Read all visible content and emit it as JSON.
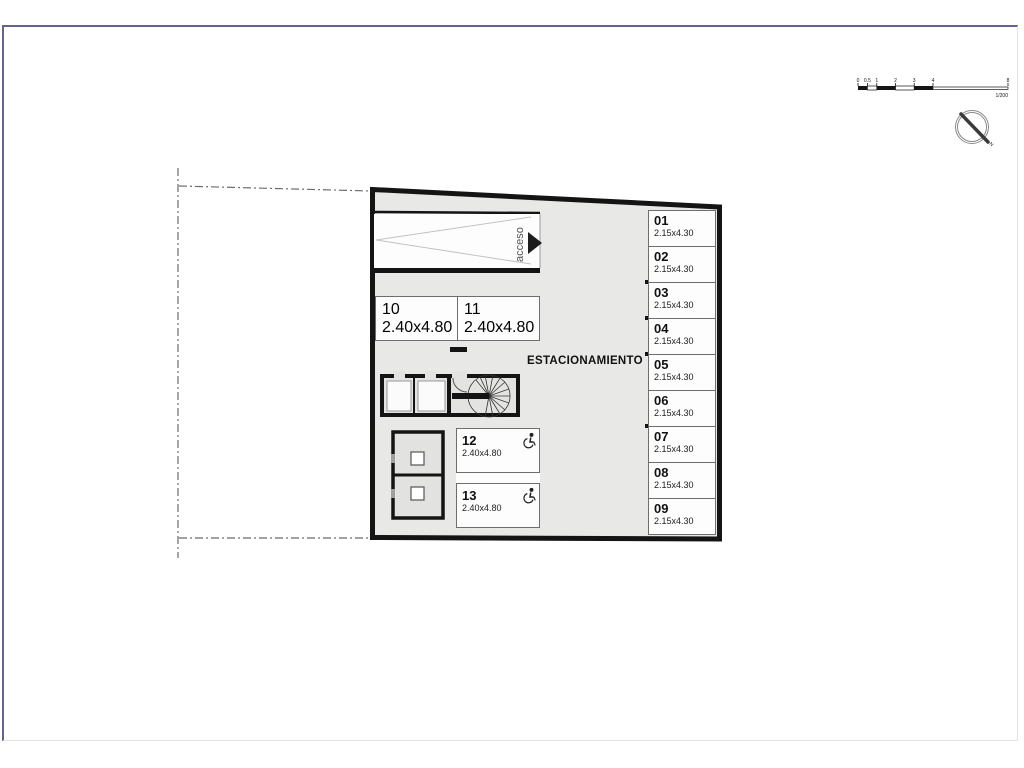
{
  "scale_bar": {
    "labels": [
      "0",
      "0.5",
      "1",
      "2",
      "3",
      "4",
      "8"
    ],
    "ratio_label": "1/200"
  },
  "compass": {
    "north_label": "N"
  },
  "plan": {
    "area_label": "ESTACIONAMIENTO",
    "ramp": {
      "label": "acceso"
    },
    "stalls_right": [
      {
        "number": "01",
        "dim": "2.15x4.30"
      },
      {
        "number": "02",
        "dim": "2.15x4.30"
      },
      {
        "number": "03",
        "dim": "2.15x4.30"
      },
      {
        "number": "04",
        "dim": "2.15x4.30"
      },
      {
        "number": "05",
        "dim": "2.15x4.30"
      },
      {
        "number": "06",
        "dim": "2.15x4.30"
      },
      {
        "number": "07",
        "dim": "2.15x4.30"
      },
      {
        "number": "08",
        "dim": "2.15x4.30"
      },
      {
        "number": "09",
        "dim": "2.15x4.30"
      }
    ],
    "stalls_top": [
      {
        "number": "10",
        "dim": "2.40x4.80"
      },
      {
        "number": "11",
        "dim": "2.40x4.80"
      }
    ],
    "stalls_accessible": [
      {
        "number": "12",
        "dim": "2.40x4.80"
      },
      {
        "number": "13",
        "dim": "2.40x4.80"
      }
    ],
    "icons": {
      "accessible": "wheelchair-icon",
      "ramp_direction": "access-arrow-icon",
      "north": "north-compass-icon"
    },
    "colors": {
      "wall": "#141414",
      "floor": "#e8e8e7",
      "paper": "#ffffff"
    }
  }
}
